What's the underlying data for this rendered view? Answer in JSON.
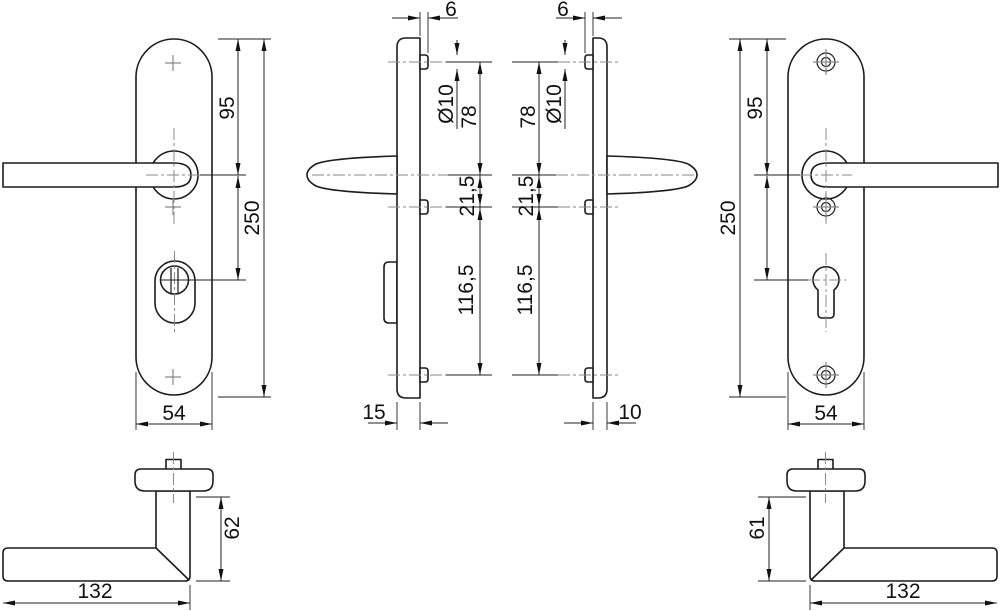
{
  "views": {
    "front_inside": {
      "top_to_handle": "95",
      "height": "250",
      "width": "54"
    },
    "profile_inside": {
      "lug_offset": "6",
      "lug_diameter": "Ø10",
      "top_spacing": "78",
      "mid_spacing": "21,5",
      "bottom_spacing": "116,5",
      "depth": "15"
    },
    "profile_outside": {
      "lug_offset": "6",
      "lug_diameter": "Ø10",
      "top_spacing": "78",
      "mid_spacing": "21,5",
      "bottom_spacing": "116,5",
      "depth": "10"
    },
    "front_outside": {
      "top_to_handle": "95",
      "height": "250",
      "width": "54"
    },
    "handle_inside": {
      "projection": "62",
      "length": "132"
    },
    "handle_outside": {
      "projection": "61",
      "length": "132"
    }
  }
}
